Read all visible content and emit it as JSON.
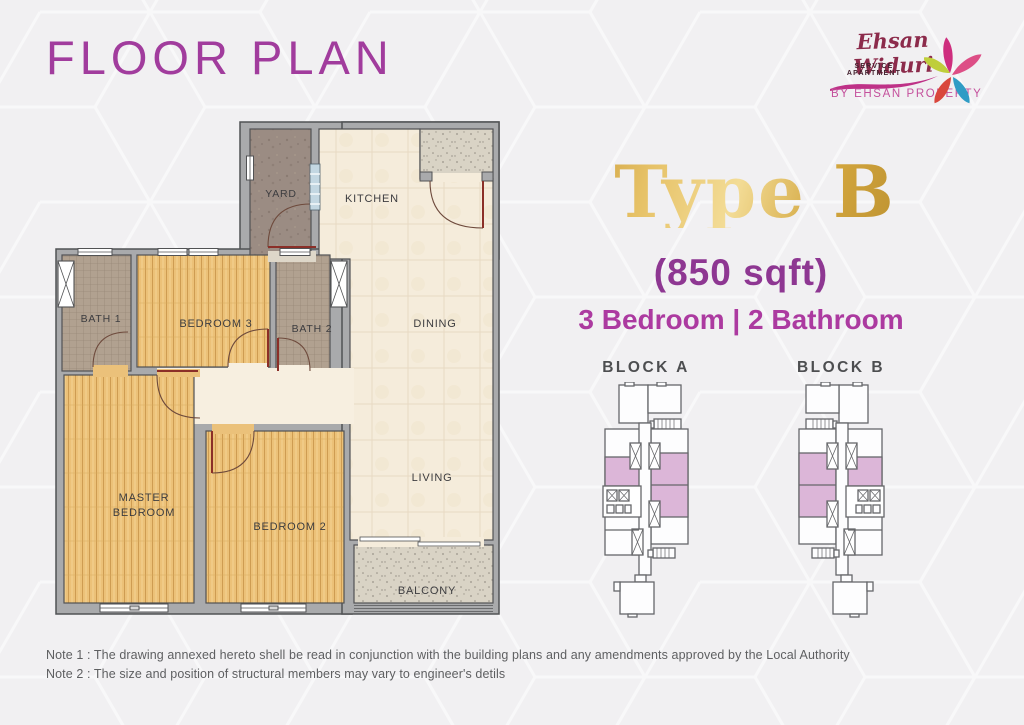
{
  "page": {
    "title": "FLOOR PLAN"
  },
  "logo": {
    "brand_script": "Ehsan Widuri",
    "brand_sub": "SERVICE APARTMENT",
    "byline": "BY EHSAN PROPERTY"
  },
  "unit": {
    "type_title": "Type B",
    "size": "(850 sqft)",
    "config": "3 Bedroom | 2 Bathroom"
  },
  "floorplan": {
    "labels": {
      "yard": "YARD",
      "kitchen": "KITCHEN",
      "dining": "DINING",
      "living": "LIVING",
      "balcony": "BALCONY",
      "bath1": "BATH 1",
      "bath2": "BATH 2",
      "bedroom3": "BEDROOM 3",
      "bedroom2": "BEDROOM 2",
      "master_line1": "MASTER",
      "master_line2": "BEDROOM"
    }
  },
  "blocks": [
    {
      "label": "BLOCK A"
    },
    {
      "label": "BLOCK B"
    }
  ],
  "notes": [
    "Note 1 : The drawing annexed hereto shell be read in conjunction with the building plans and any amendments approved by the Local Authority",
    "Note 2 : The size and position of structural  members may vary to engineer's detils"
  ],
  "colors": {
    "title_purple": "#a13c9d",
    "size_purple": "#8e3792",
    "config_magenta": "#ac3aa0",
    "gold": "#d4a43c",
    "highlight_unit_pink": "#dcb6d8"
  }
}
